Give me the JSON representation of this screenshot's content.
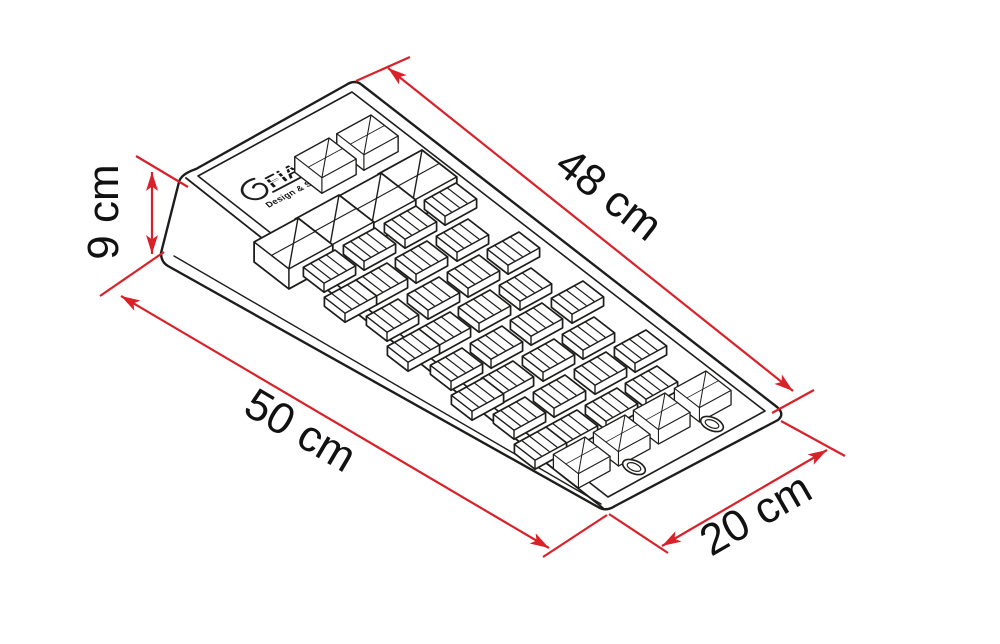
{
  "diagram": {
    "logo": {
      "brand": "FIAMMA",
      "tagline": "Design & Style Made in Italy"
    },
    "dimensions": [
      {
        "id": "top-length",
        "label": "48 cm"
      },
      {
        "id": "height",
        "label": "9 cm"
      },
      {
        "id": "base-length",
        "label": "50 cm"
      },
      {
        "id": "width",
        "label": "20 cm"
      }
    ],
    "colors": {
      "dimension_lines": "#d92129",
      "drawing_lines": "#1d1d1b",
      "background": "#ffffff"
    }
  }
}
